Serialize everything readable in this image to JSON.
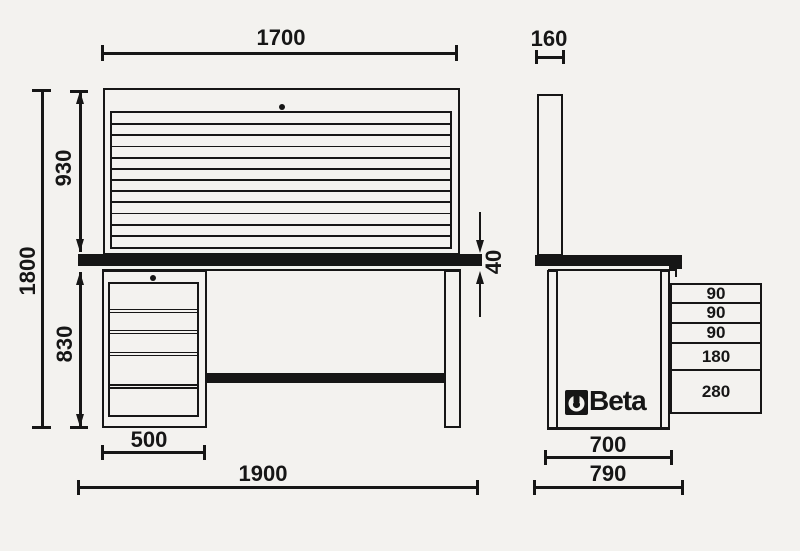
{
  "drawing": {
    "brand": "Beta",
    "front": {
      "dim_panel_width": "1700",
      "dim_total_height": "1800",
      "dim_panel_height": "930",
      "dim_under_height": "830",
      "dim_top_thickness": "40",
      "dim_cabinet_width": "500",
      "dim_total_width": "1900"
    },
    "side": {
      "dim_panel_depth": "160",
      "dim_bench_depth": "700",
      "dim_total_depth": "790",
      "drawer_heights": [
        "90",
        "90",
        "90",
        "180",
        "280"
      ]
    }
  }
}
